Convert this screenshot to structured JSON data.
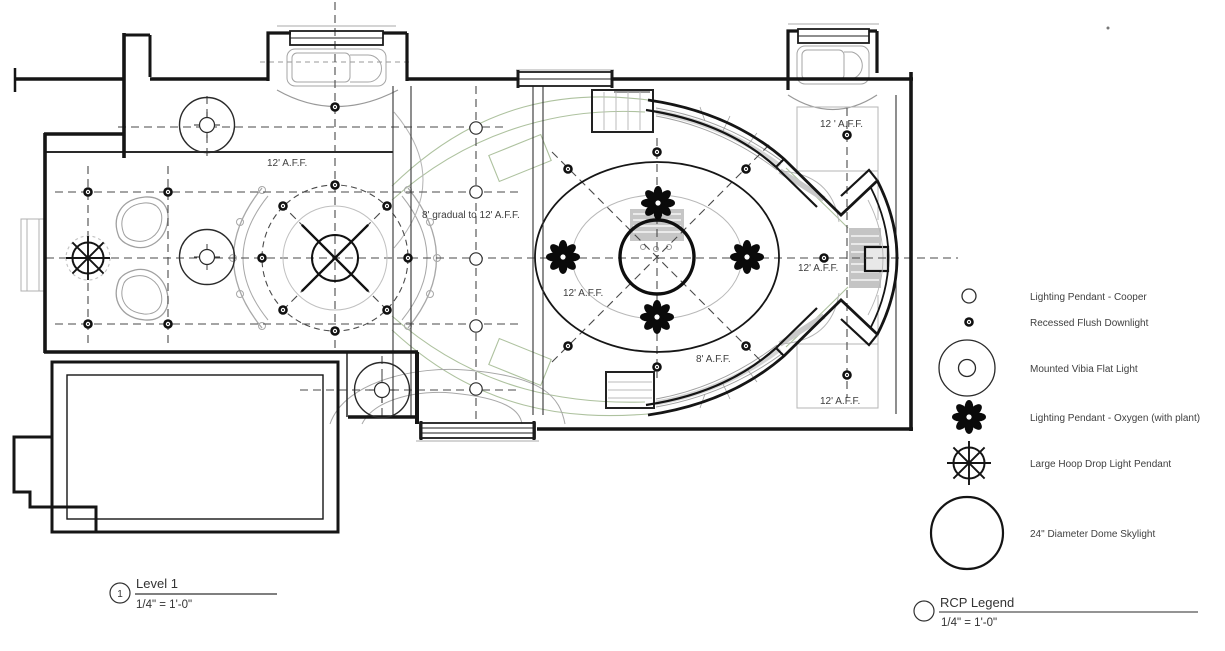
{
  "drawing": {
    "annotations": [
      {
        "text": "12' A.F.F.",
        "x": 267,
        "y": 166
      },
      {
        "text": "8' gradual to 12' A.F.F.",
        "x": 422,
        "y": 218
      },
      {
        "text": "12' A.F.F.",
        "x": 563,
        "y": 296
      },
      {
        "text": "8' A.F.F.",
        "x": 696,
        "y": 362
      },
      {
        "text": "12 ' A.F.F.",
        "x": 820,
        "y": 127
      },
      {
        "text": "12' A.F.F.",
        "x": 798,
        "y": 271
      },
      {
        "text": "12' A.F.F.",
        "x": 820,
        "y": 404
      }
    ],
    "view_title": {
      "number": "1",
      "name": "Level 1",
      "scale": "1/4\" = 1'-0\""
    },
    "legend": {
      "title": "RCP Legend",
      "scale": "1/4\" = 1'-0\"",
      "items": [
        {
          "symbol": "cooper",
          "label": "Lighting Pendant - Cooper"
        },
        {
          "symbol": "downlight",
          "label": "Recessed Flush Downlight"
        },
        {
          "symbol": "vibia",
          "label": "Mounted Vibia Flat Light"
        },
        {
          "symbol": "oxygen",
          "label": "Lighting Pendant - Oxygen (with plant)"
        },
        {
          "symbol": "hoop",
          "label": "Large Hoop Drop Light Pendant"
        },
        {
          "symbol": "dome",
          "label": "24\" Diameter Dome Skylight"
        }
      ]
    },
    "colors": {
      "wall": "#1c1c1c",
      "grid": "#4a4a4a",
      "furniture": "#a8a8a8",
      "plant": "#aec29f",
      "text": "#3d3d3d"
    }
  }
}
